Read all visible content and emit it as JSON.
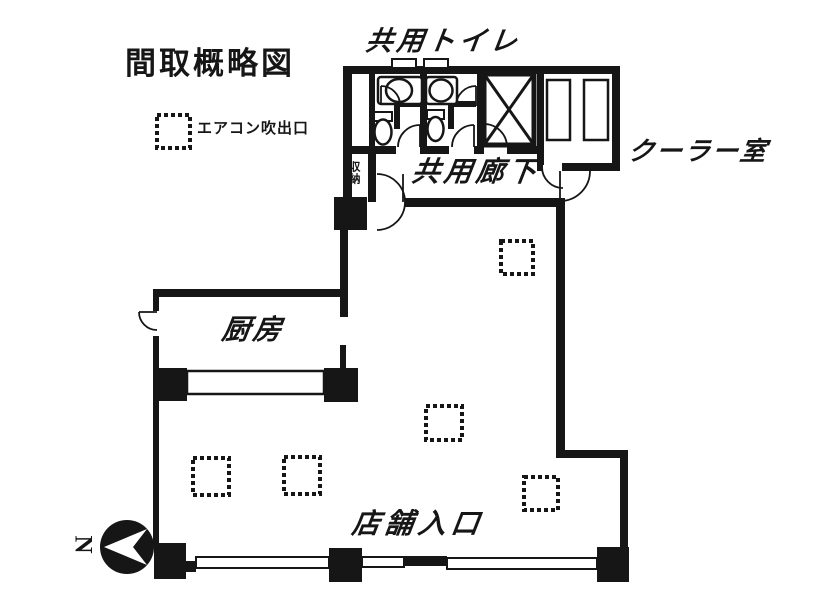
{
  "title": "間取概略図",
  "legend": {
    "icon": "air-outlet-icon",
    "label": "エアコン吹出口"
  },
  "rooms": {
    "shared_toilet": "共用トイレ",
    "cooler_room": "クーラー室",
    "shared_corridor": "共用廊下",
    "storage": "収納",
    "kitchen": "厨房",
    "store_entrance": "店舗入口"
  },
  "compass": {
    "icon": "north-arrow-icon",
    "direction_label": "N"
  },
  "plan": {
    "air_outlet_count_in_plan": 5,
    "fixtures": [
      "sink-icon",
      "toilet-icon",
      "elevator-shaft-x",
      "cooler-unit",
      "kitchen-counter",
      "door-swing-arc"
    ]
  },
  "colors": {
    "ink": "#161616",
    "paper": "#ffffff"
  }
}
